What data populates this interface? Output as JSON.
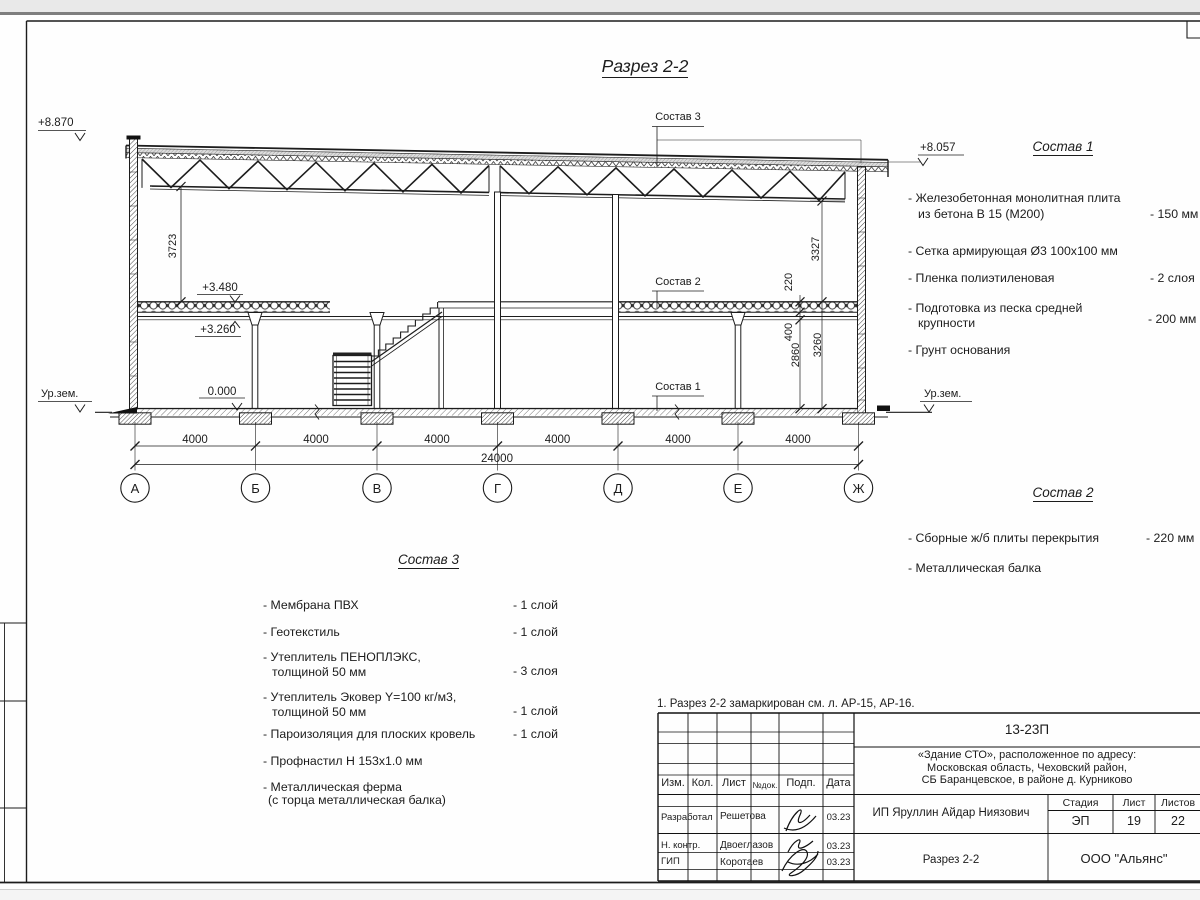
{
  "drawing": {
    "title": "Разрез 2-2",
    "levels": {
      "roof_left": "+8.870",
      "roof_right": "+8.057",
      "ground_label": "Ур.зем.",
      "slab_top": "+3.480",
      "beam_bottom": "+3.260",
      "floor_zero": "0.000"
    },
    "dims": {
      "truss_clear": "3723",
      "right_truss_clear": "3327",
      "slab_thickness": "220",
      "slab_beam": "400",
      "first_floor_clear": "2860",
      "beam_level": "3260",
      "bay": "4000",
      "total": "24000"
    },
    "axes": [
      "А",
      "Б",
      "В",
      "Г",
      "Д",
      "Е",
      "Ж"
    ],
    "callouts": {
      "sostav1": "Состав 1",
      "sostav2": "Состав 2",
      "sostav3": "Состав 3"
    }
  },
  "lists": {
    "sostav1": {
      "title": "Состав 1",
      "items": [
        {
          "line1": "- Железобетонная  монолитная плита",
          "line2": "из бетона В 15 (М200)",
          "value": "- 150 мм"
        },
        {
          "line1": "- Сетка армирующая Ø3 100х100 мм"
        },
        {
          "line1": "- Пленка полиэтиленовая",
          "value": "- 2 слоя"
        },
        {
          "line1": "- Подготовка из песка средней",
          "line2": "крупности",
          "value": "- 200 мм"
        },
        {
          "line1": "- Грунт основания"
        }
      ]
    },
    "sostav2": {
      "title": "Состав 2",
      "items": [
        {
          "line1": "- Сборные ж/б плиты перекрытия",
          "value": "- 220 мм"
        },
        {
          "line1": "- Металлическая  балка"
        }
      ]
    },
    "sostav3": {
      "title": "Состав 3",
      "items": [
        {
          "line1": "- Мембрана ПВХ",
          "value": "- 1 слой"
        },
        {
          "line1": "- Геотекстиль",
          "value": "- 1 слой"
        },
        {
          "line1": "- Утеплитель ПЕНОПЛЭКС,",
          "line2": "толщиной 50 мм",
          "value": "- 3 слоя"
        },
        {
          "line1": "- Утеплитель Эковер Y=100 кг/м3,",
          "line2": "толщиной 50 мм",
          "value": "- 1 слой"
        },
        {
          "line1": "- Пароизоляция для плоских кровель",
          "value": "- 1 слой"
        },
        {
          "line1": "- Профнастил Н 153х1.0 мм"
        },
        {
          "line1": "- Металлическая ферма",
          "line2": "(с торца металлическая балка)"
        }
      ]
    }
  },
  "note": "1. Разрез 2-2 замаркирован см. л. АР-15, АР-16.",
  "titleblock": {
    "doc_number": "13-23П",
    "object_line1": "«Здание СТО», расположенное по адресу:",
    "object_line2": "Московская область, Чеховский район,",
    "object_line3": "СБ Баранцевское, в районе д. Курниково",
    "client": "ИП Яруллин Айдар Ниязович",
    "sheet_name": "Разрез 2-2",
    "organization": "ООО \"Альянс\"",
    "columns": {
      "izm": "Изм.",
      "kol": "Кол.",
      "list": "Лист",
      "ndok": "№док.",
      "podp": "Подп.",
      "data": "Дата"
    },
    "stage": {
      "label": "Стадия",
      "value": "ЭП"
    },
    "sheet": {
      "label": "Лист",
      "value": "19"
    },
    "sheets": {
      "label": "Листов",
      "value": "22"
    },
    "rows": [
      {
        "role": "Разработал",
        "name": "Решетова",
        "date": "03.23"
      },
      {
        "role": "Н. контр.",
        "name": "Двоеглазов",
        "date": "03.23"
      },
      {
        "role": "ГИП",
        "name": "Коротаев",
        "date": "03.23"
      }
    ]
  }
}
